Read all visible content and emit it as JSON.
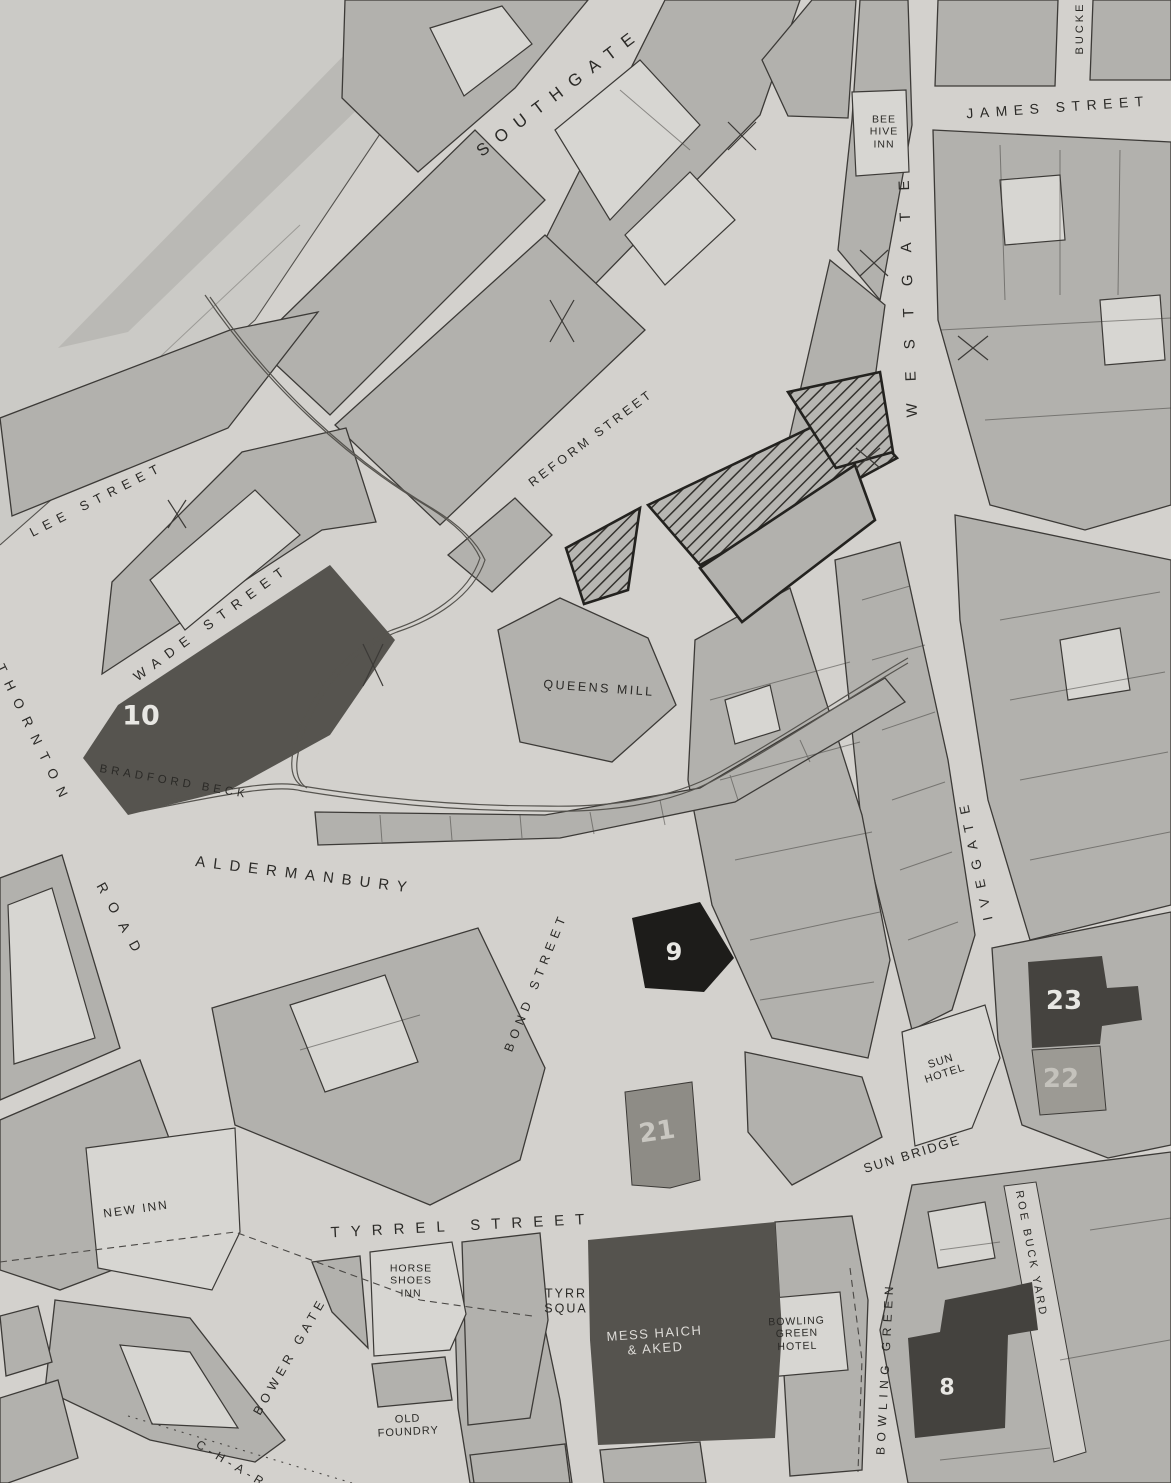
{
  "map": {
    "streets": {
      "southgate": "SOUTHGATE",
      "james_street": "JAMES STREET",
      "buck": "BUCKE",
      "westgate": "WESTGATE",
      "reform_street": "REFORM STREET",
      "lee_street": "LEE STREET",
      "wade_street": "WADE STREET",
      "thornton": "THORNTON",
      "road": "ROAD",
      "aldermanbury": "ALDERMANBURY",
      "bond_street": "BOND STREET",
      "ivegate": "IVEGATE",
      "sun_bridge": "SUN BRIDGE",
      "roebuck_yard": "ROE BUCK YARD",
      "tyrrel_street": "TYRREL STREET",
      "bower_gate": "BOWER GATE",
      "bowling_green": "BOWLING GREEN",
      "char": "C-H-A-R"
    },
    "places": {
      "bee_hive_inn": {
        "l1": "BEE",
        "l2": "HIVE",
        "l3": "INN"
      },
      "queens_mill": "QUEENS MILL",
      "bradford_beck": "BRADFORD BECK",
      "sun_hotel": {
        "l1": "SUN",
        "l2": "HOTEL"
      },
      "new_inn": "NEW INN",
      "horse_shoes_inn": {
        "l1": "HORSE",
        "l2": "SHOES",
        "l3": "INN"
      },
      "tyrrel_square": {
        "l1": "TYRR",
        "l2": "SQUA"
      },
      "mess_haich_aked": {
        "l1": "MESS HAICH",
        "l2": "& AKED"
      },
      "bowling_green_hotel": {
        "l1": "BOWLING",
        "l2": "GREEN",
        "l3": "HOTEL"
      },
      "old_foundry": {
        "l1": "OLD",
        "l2": "FOUNDRY"
      }
    },
    "parcels": {
      "p10": "10",
      "p9": "9",
      "p21": "21",
      "p22": "22",
      "p23": "23",
      "p8": "8"
    },
    "colors": {
      "paper": "#d3d1cd",
      "building": "#b2b1ad",
      "building_light": "#d7d6d2",
      "outline": "#3c3a37",
      "dark_parcel": "#56544f",
      "black_parcel": "#1d1c1a",
      "label_text": "#2b2a27",
      "number_text": "#e8e7e3"
    }
  }
}
